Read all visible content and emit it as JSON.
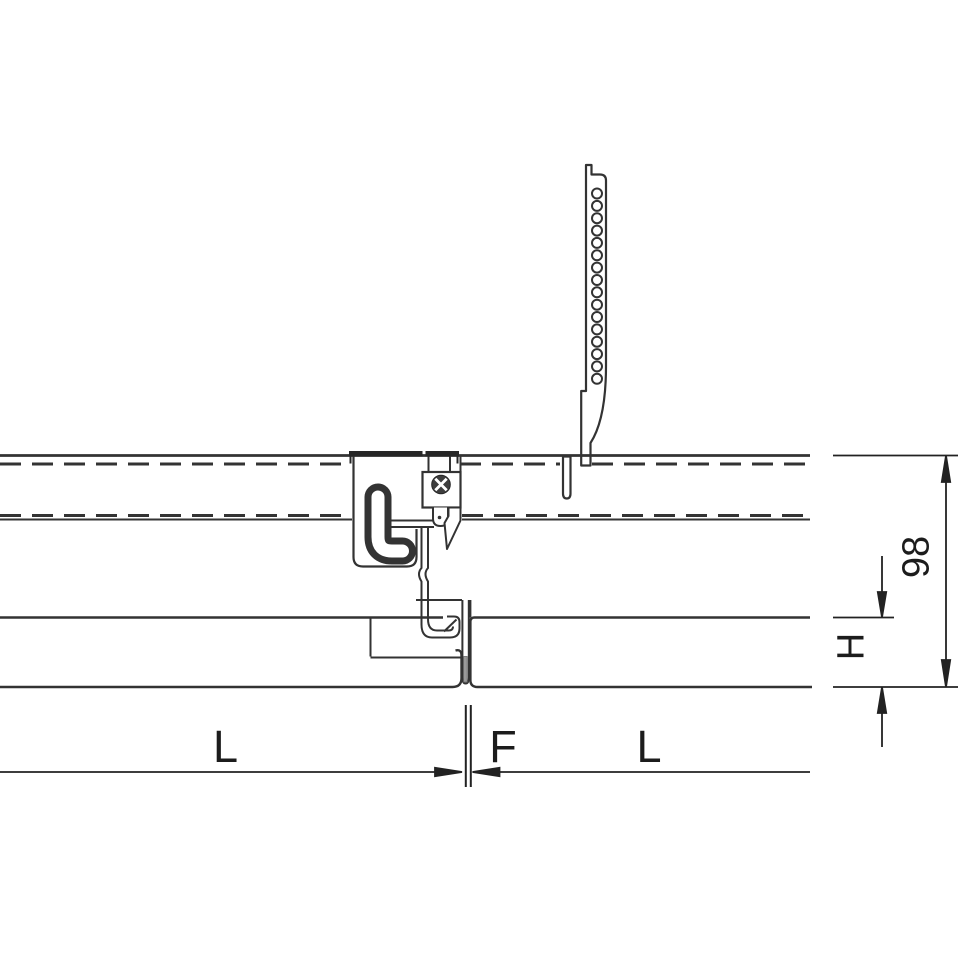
{
  "diagram": {
    "title": "Suspended metal panel ceiling — cross-section detail at panel joint with carrier rail, perforated hanger strap and panel clip",
    "dimensions": {
      "overall_drop": "98",
      "panel_height": "H",
      "left_panel_length": "L",
      "joint_gap": "F",
      "right_panel_length": "L"
    },
    "colors": {
      "line": "#333333",
      "dim_line": "#222222",
      "flange_dark": "#262626",
      "screw_head": "#3d3d3d",
      "section_fill": "#9a9a9a",
      "section_border": "#6b6b6b",
      "background": "#ffffff"
    }
  }
}
